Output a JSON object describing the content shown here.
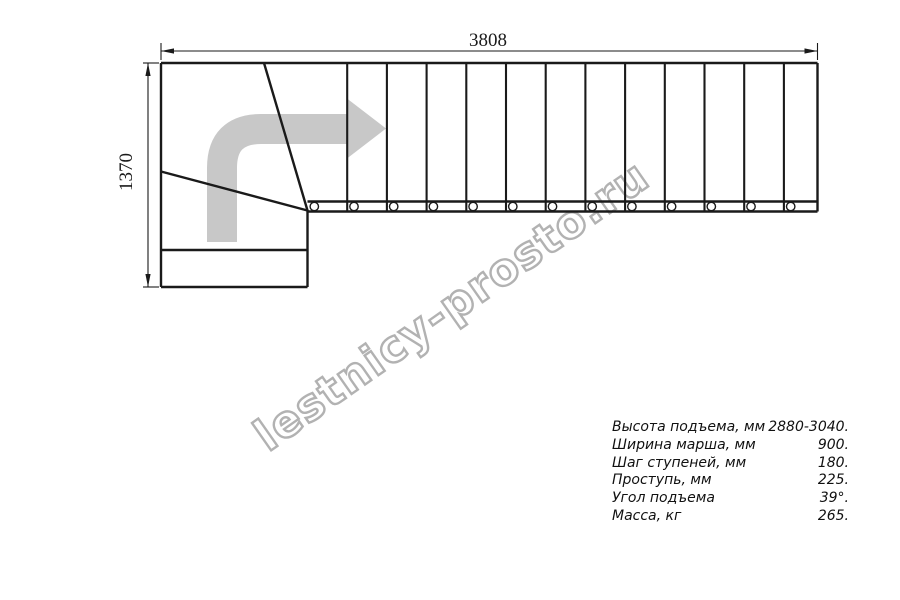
{
  "drawing": {
    "top_dimension_label": "3808",
    "left_dimension_label": "1370",
    "straight_treads_count": 13,
    "direction_arrow_icon": "turn-right-then-forward-arrow"
  },
  "watermark": {
    "text": "lestnicy-prosto.ru"
  },
  "specs": {
    "rows": [
      {
        "label": "Высота подъема, мм",
        "value": "2880-3040."
      },
      {
        "label": "Ширина марша, мм",
        "value": "900."
      },
      {
        "label": "Шаг ступеней, мм",
        "value": "180."
      },
      {
        "label": "Проступь, мм",
        "value": "225."
      },
      {
        "label": "Угол подъема",
        "value": "39°."
      },
      {
        "label": "Масса, кг",
        "value": "265."
      }
    ]
  },
  "colors": {
    "line_color": "#1a1a1a",
    "arrow_fill": "#c8c8c8",
    "watermark_outline": "#b2b2b2"
  }
}
